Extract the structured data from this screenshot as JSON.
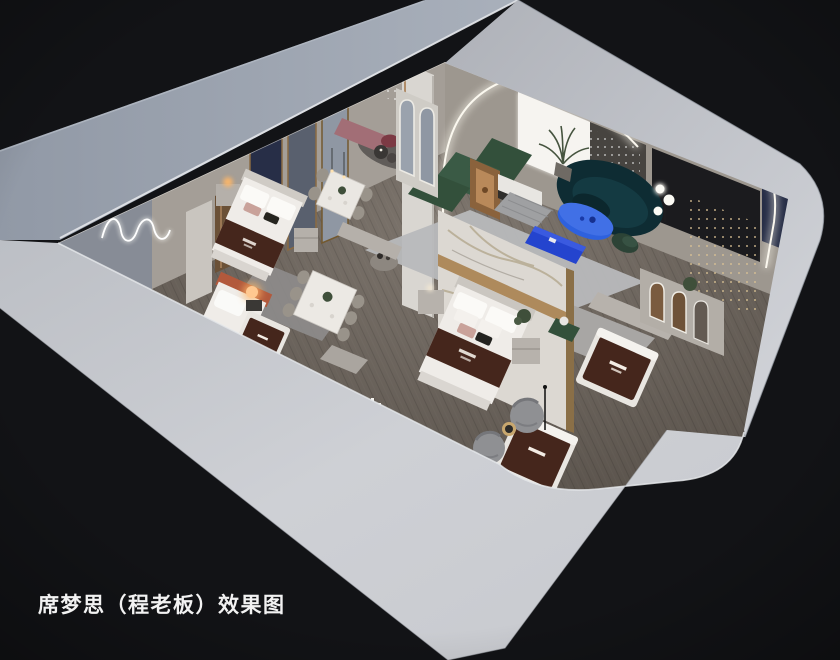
{
  "caption": {
    "text": "席梦思（程老板）效果图"
  },
  "scene": {
    "kind": "isometric-cutaway-interior-render",
    "objects": [
      "showroom-floorplan",
      "center-bed",
      "left-bed",
      "corner-bed",
      "display-mattresses",
      "green-sectional-sofa",
      "teal-curved-sofa",
      "blue-oval-coffee-table",
      "blue-media-cabinet",
      "marble-feature-wall",
      "arched-mirrors",
      "led-arch-wall",
      "dining-set-upper",
      "dining-set-lower",
      "barrel-chairs",
      "cascade-string-lights",
      "wavy-neon-light",
      "sphere-floor-lamp",
      "pink-bench"
    ]
  },
  "palette": {
    "bg": "#121316",
    "wallTop": "#9aa2af",
    "wallTopDark": "#8c94a1",
    "wallSide": "#c6c8ce",
    "wallBright": "#d3d5da",
    "wallInner": "#a49e97",
    "wallInnerCool": "#878c96",
    "floor": "#6e6660",
    "floorDark": "#5b554f",
    "rugLounge": "#b8b9bc",
    "rugDark": "#8e8c8c",
    "rugLight": "#a8a6a4",
    "marble": "#dcd8d2",
    "gold": "#a8824f",
    "navy": "#272e47",
    "blackWall": "#1b1b1e",
    "drape": "#474440",
    "backlit": "#f6f4f0",
    "greenSofa": "#33503b",
    "tealSofa": "#0e2c33",
    "blueTable": "#2e61de",
    "blueCabinet": "#2444ce",
    "brownRunner": "#45261c",
    "mattress": "#efece8",
    "wood": "#a57a4e",
    "woodDark": "#6b5137",
    "warmLamp": "#ffb768",
    "pinkBench": "#a26e76",
    "crimson": "#7c3a44",
    "chairGreige": "#99938a",
    "barrelGray": "#8f9093",
    "plantGreen": "#3f4f3a",
    "led": "#f5f2e7",
    "white": "#f2f2f2"
  }
}
